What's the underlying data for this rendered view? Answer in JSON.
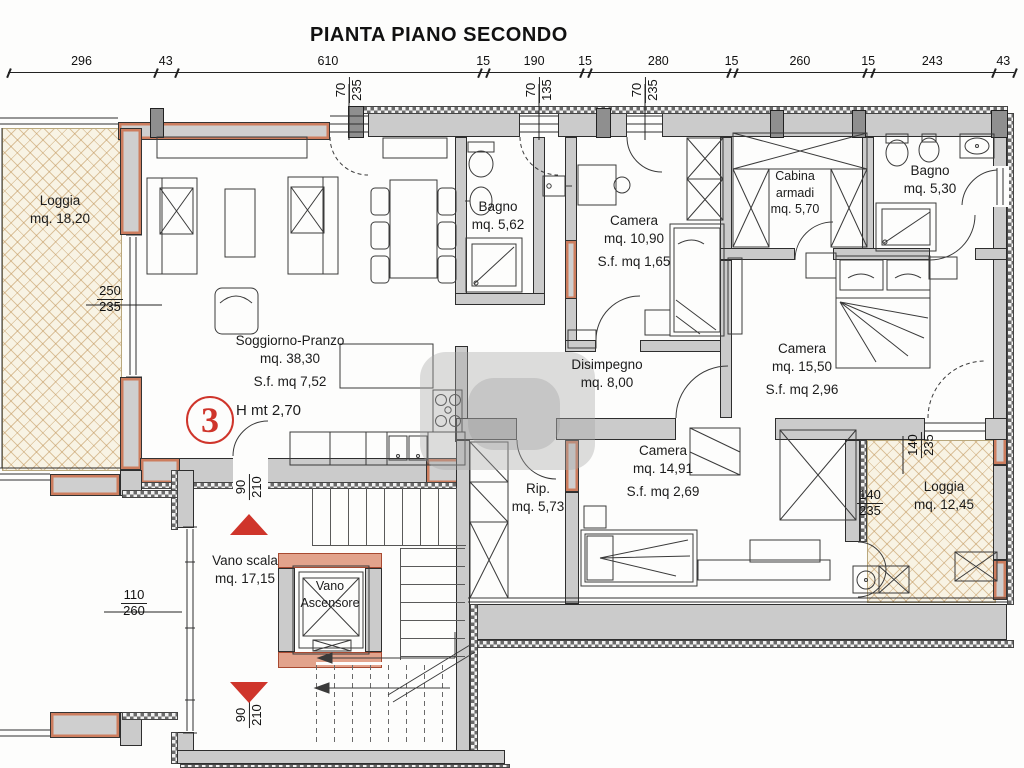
{
  "title": "PIANTA PIANO SECONDO",
  "top_dims": [
    "296",
    "43",
    "610",
    "15",
    "190",
    "15",
    "280",
    "15",
    "260",
    "15",
    "243",
    "43"
  ],
  "rooms": {
    "loggia_left": {
      "name": "Loggia",
      "area": "mq. 18,20"
    },
    "soggiorno": {
      "name": "Soggiorno-Pranzo",
      "area": "mq. 38,30",
      "sf": "S.f. mq 7,52"
    },
    "bagno1": {
      "name": "Bagno",
      "area": "mq. 5,62"
    },
    "camera1": {
      "name": "Camera",
      "area": "mq. 10,90",
      "sf": "S.f. mq 1,65"
    },
    "cabina": {
      "name": "Cabina armadi",
      "area": "mq. 5,70"
    },
    "bagno2": {
      "name": "Bagno",
      "area": "mq. 5,30"
    },
    "camera2": {
      "name": "Camera",
      "area": "mq. 15,50",
      "sf": "S.f. mq 2,96"
    },
    "disimpegno": {
      "name": "Disimpegno",
      "area": "mq. 8,00"
    },
    "camera3": {
      "name": "Camera",
      "area": "mq. 14,91",
      "sf": "S.f. mq 2,69"
    },
    "rip": {
      "name": "Rip.",
      "area": "mq. 5,73"
    },
    "loggia_right": {
      "name": "Loggia",
      "area": "mq. 12,45"
    },
    "vano_scala": {
      "name": "Vano scala",
      "area": "mq. 17,15"
    },
    "ascensore": {
      "name": "Vano Ascensore"
    }
  },
  "unit": {
    "number": "3",
    "height_label": "H mt 2,70"
  },
  "markers": {
    "loggia_left_win": {
      "num": "250",
      "den": "235"
    },
    "top_win1": {
      "num": "70",
      "den": "235"
    },
    "top_win2": {
      "num": "70",
      "den": "135"
    },
    "top_win3": {
      "num": "70",
      "den": "235"
    },
    "scala_door_top": {
      "num": "90",
      "den": "210"
    },
    "scala_door_bottom": {
      "num": "90",
      "den": "210"
    },
    "scala_win": {
      "num": "110",
      "den": "260"
    },
    "loggia_right_win_v": {
      "num": "140",
      "den": "235"
    },
    "loggia_right_win_h": {
      "num": "140",
      "den": "235"
    }
  },
  "colors": {
    "wall_gray": "#cbcbcb",
    "accent_salmon": "#cd7d5e",
    "marker_red": "#cf352b",
    "line": "#2e2e2e",
    "parquet": "#f8f3e4"
  }
}
